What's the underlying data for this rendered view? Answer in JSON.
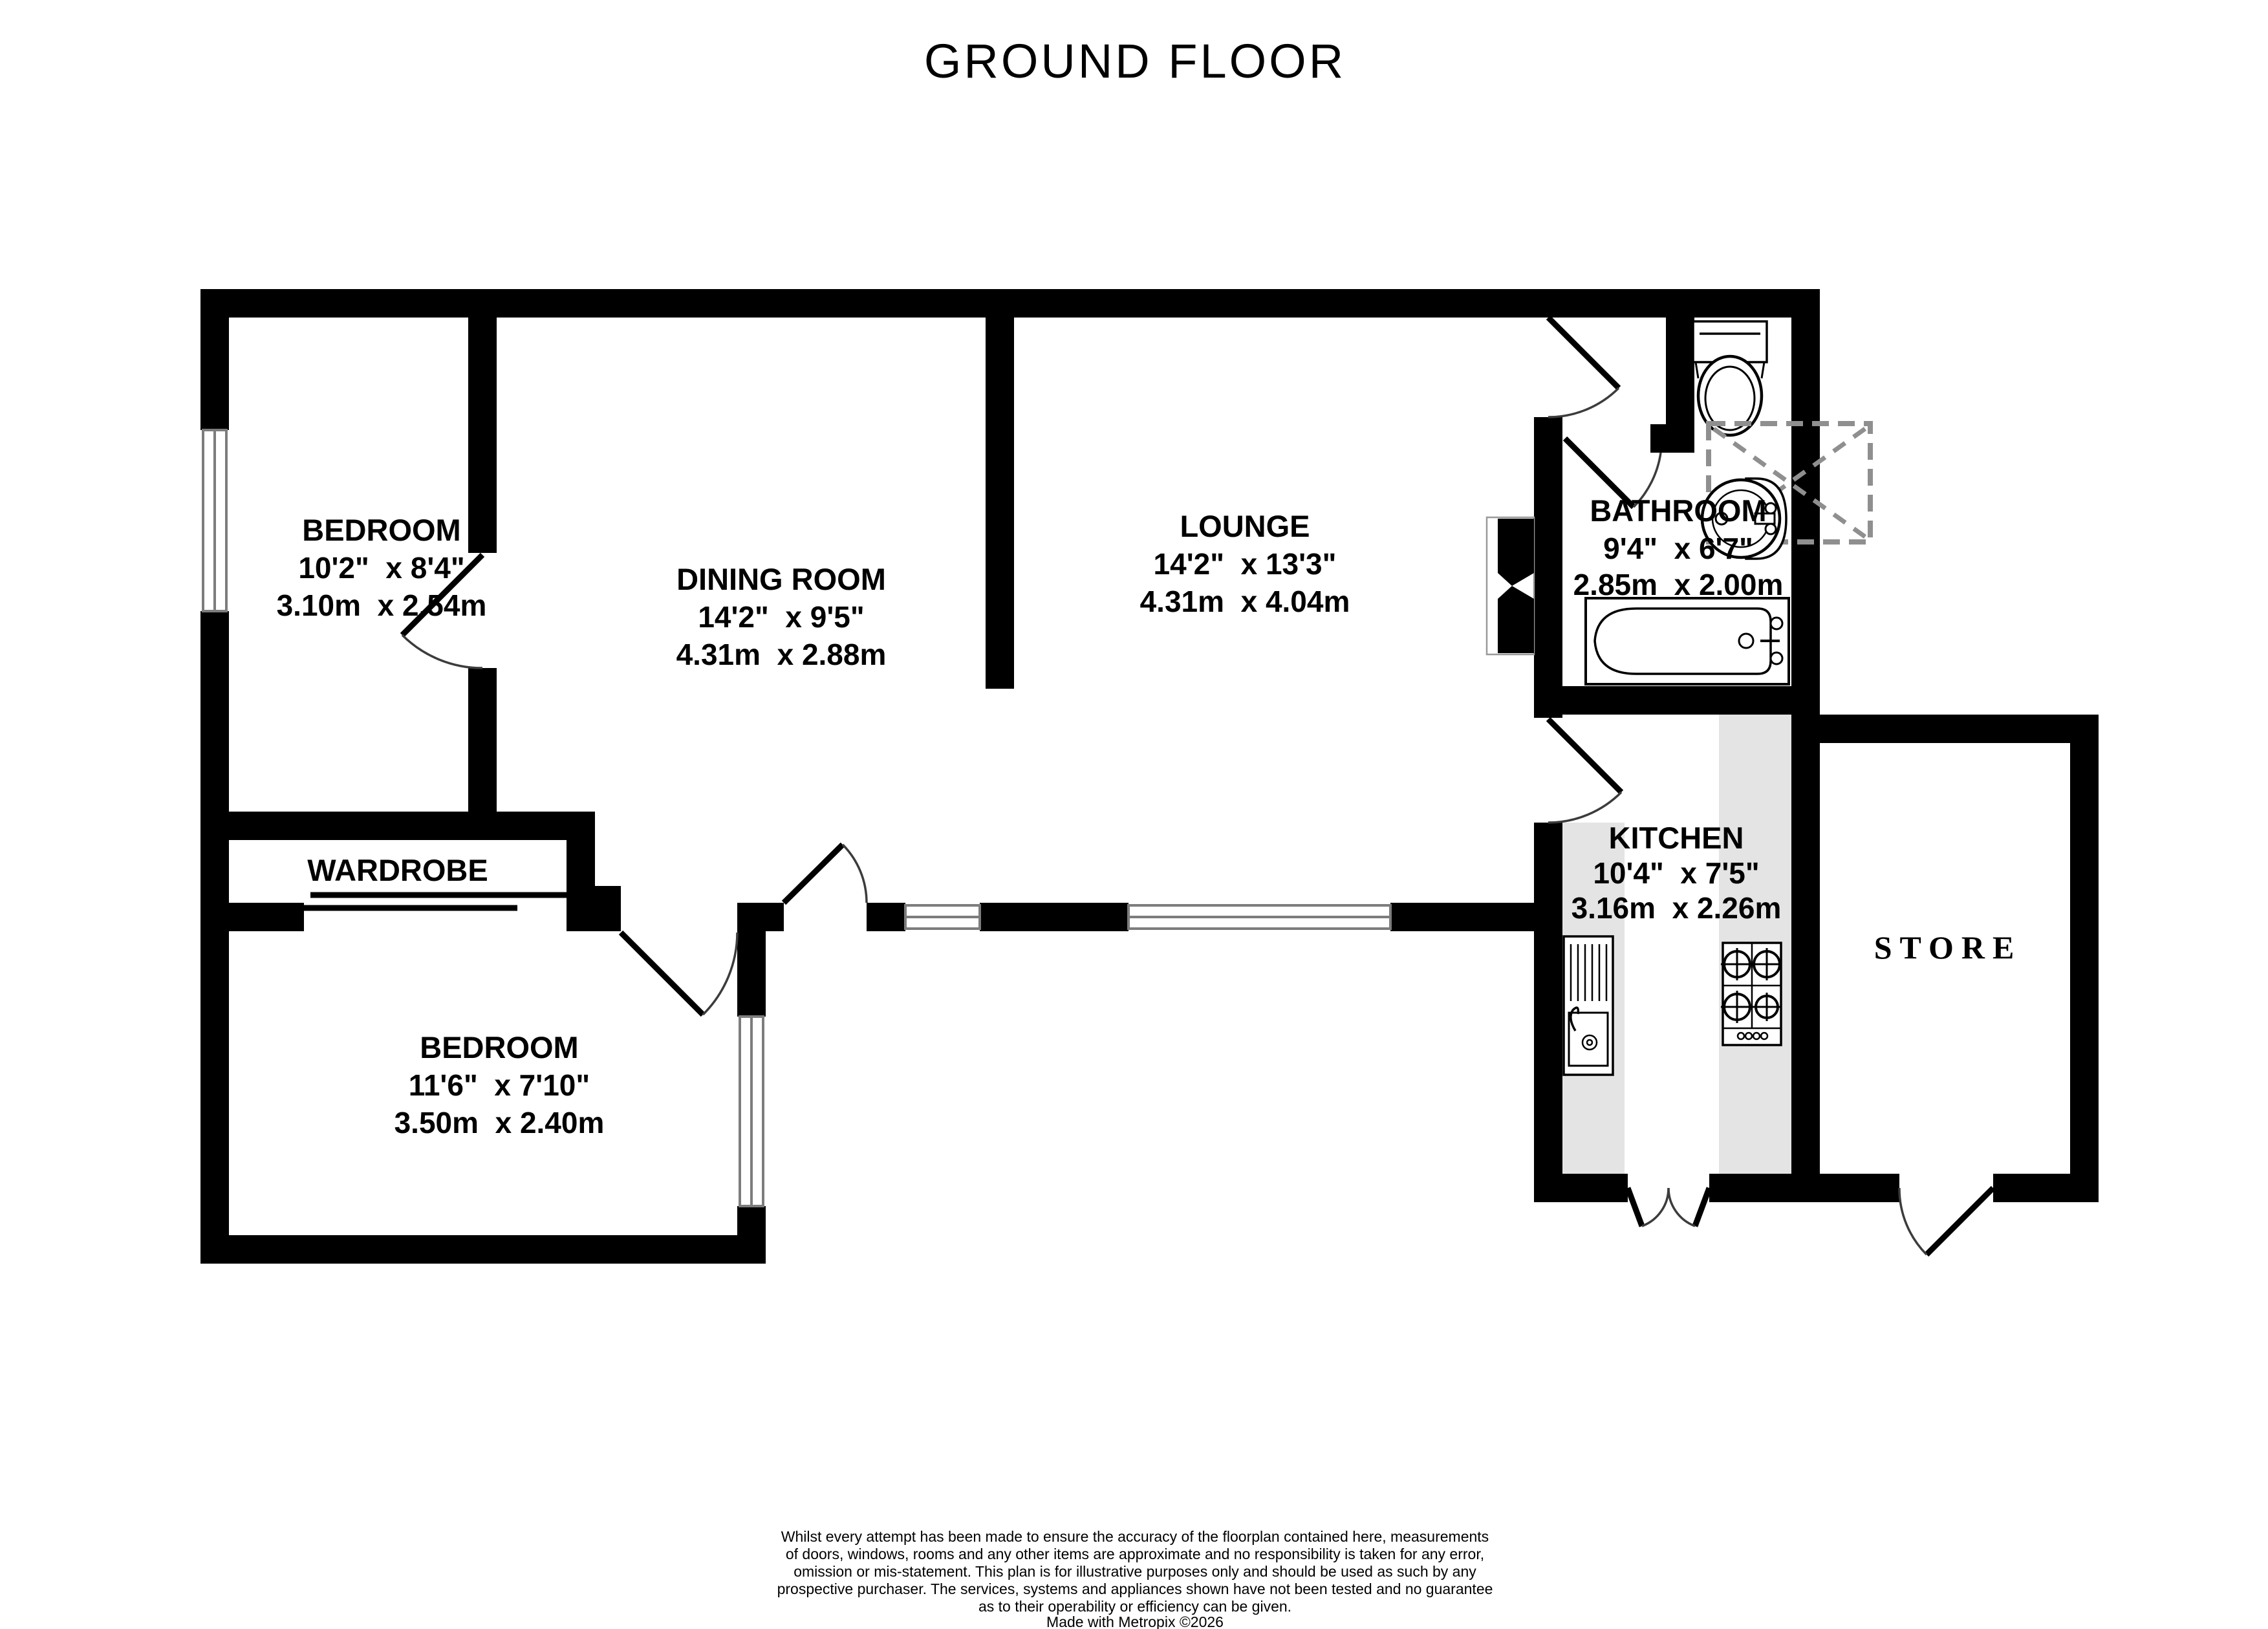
{
  "title": "GROUND FLOOR",
  "rooms": [
    {
      "id": "bedroom-1",
      "name": "BEDROOM",
      "dims_imperial": "10'2\"  x 8'4\"",
      "dims_metric": "3.10m  x 2.54m"
    },
    {
      "id": "dining-room",
      "name": "DINING ROOM",
      "dims_imperial": "14'2\"  x 9'5\"",
      "dims_metric": "4.31m  x 2.88m"
    },
    {
      "id": "lounge",
      "name": "LOUNGE",
      "dims_imperial": "14'2\"  x 13'3\"",
      "dims_metric": "4.31m  x 4.04m"
    },
    {
      "id": "bathroom",
      "name": "BATHROOM",
      "dims_imperial": "9'4\"  x 6'7\"",
      "dims_metric": "2.85m  x 2.00m"
    },
    {
      "id": "wardrobe",
      "name": "WARDROBE"
    },
    {
      "id": "bedroom-2",
      "name": "BEDROOM",
      "dims_imperial": "11'6\"  x 7'10\"",
      "dims_metric": "3.50m  x 2.40m"
    },
    {
      "id": "kitchen",
      "name": "KITCHEN",
      "dims_imperial": "10'4\"  x 7'5\"",
      "dims_metric": "3.16m  x 2.26m"
    },
    {
      "id": "store",
      "name": "STORE"
    }
  ],
  "fixtures": [
    "toilet",
    "bathroom-sink",
    "shower-unit",
    "bath",
    "fireplace",
    "kitchen-sink-unit",
    "hob",
    "wardrobe-sliding-doors"
  ],
  "annotations": {
    "disclaimer_lines": [
      "Whilst every attempt has been made to ensure the accuracy of the floorplan contained here, measurements",
      "of doors, windows, rooms and any other items are approximate and no responsibility is taken for any error,",
      "omission or mis-statement. This plan is for illustrative purposes only and should be used as such by any",
      "prospective purchaser. The services, systems and appliances shown have not been tested and no guarantee",
      "as to their operability or efficiency can be given."
    ],
    "made_with": "Made with Metropix ©2026"
  },
  "colors": {
    "wall": "#000000",
    "counter": "#e4e4e4",
    "window_frame": "#7d7d7d",
    "shower_outline": "#8f8f8f",
    "background": "#ffffff"
  }
}
